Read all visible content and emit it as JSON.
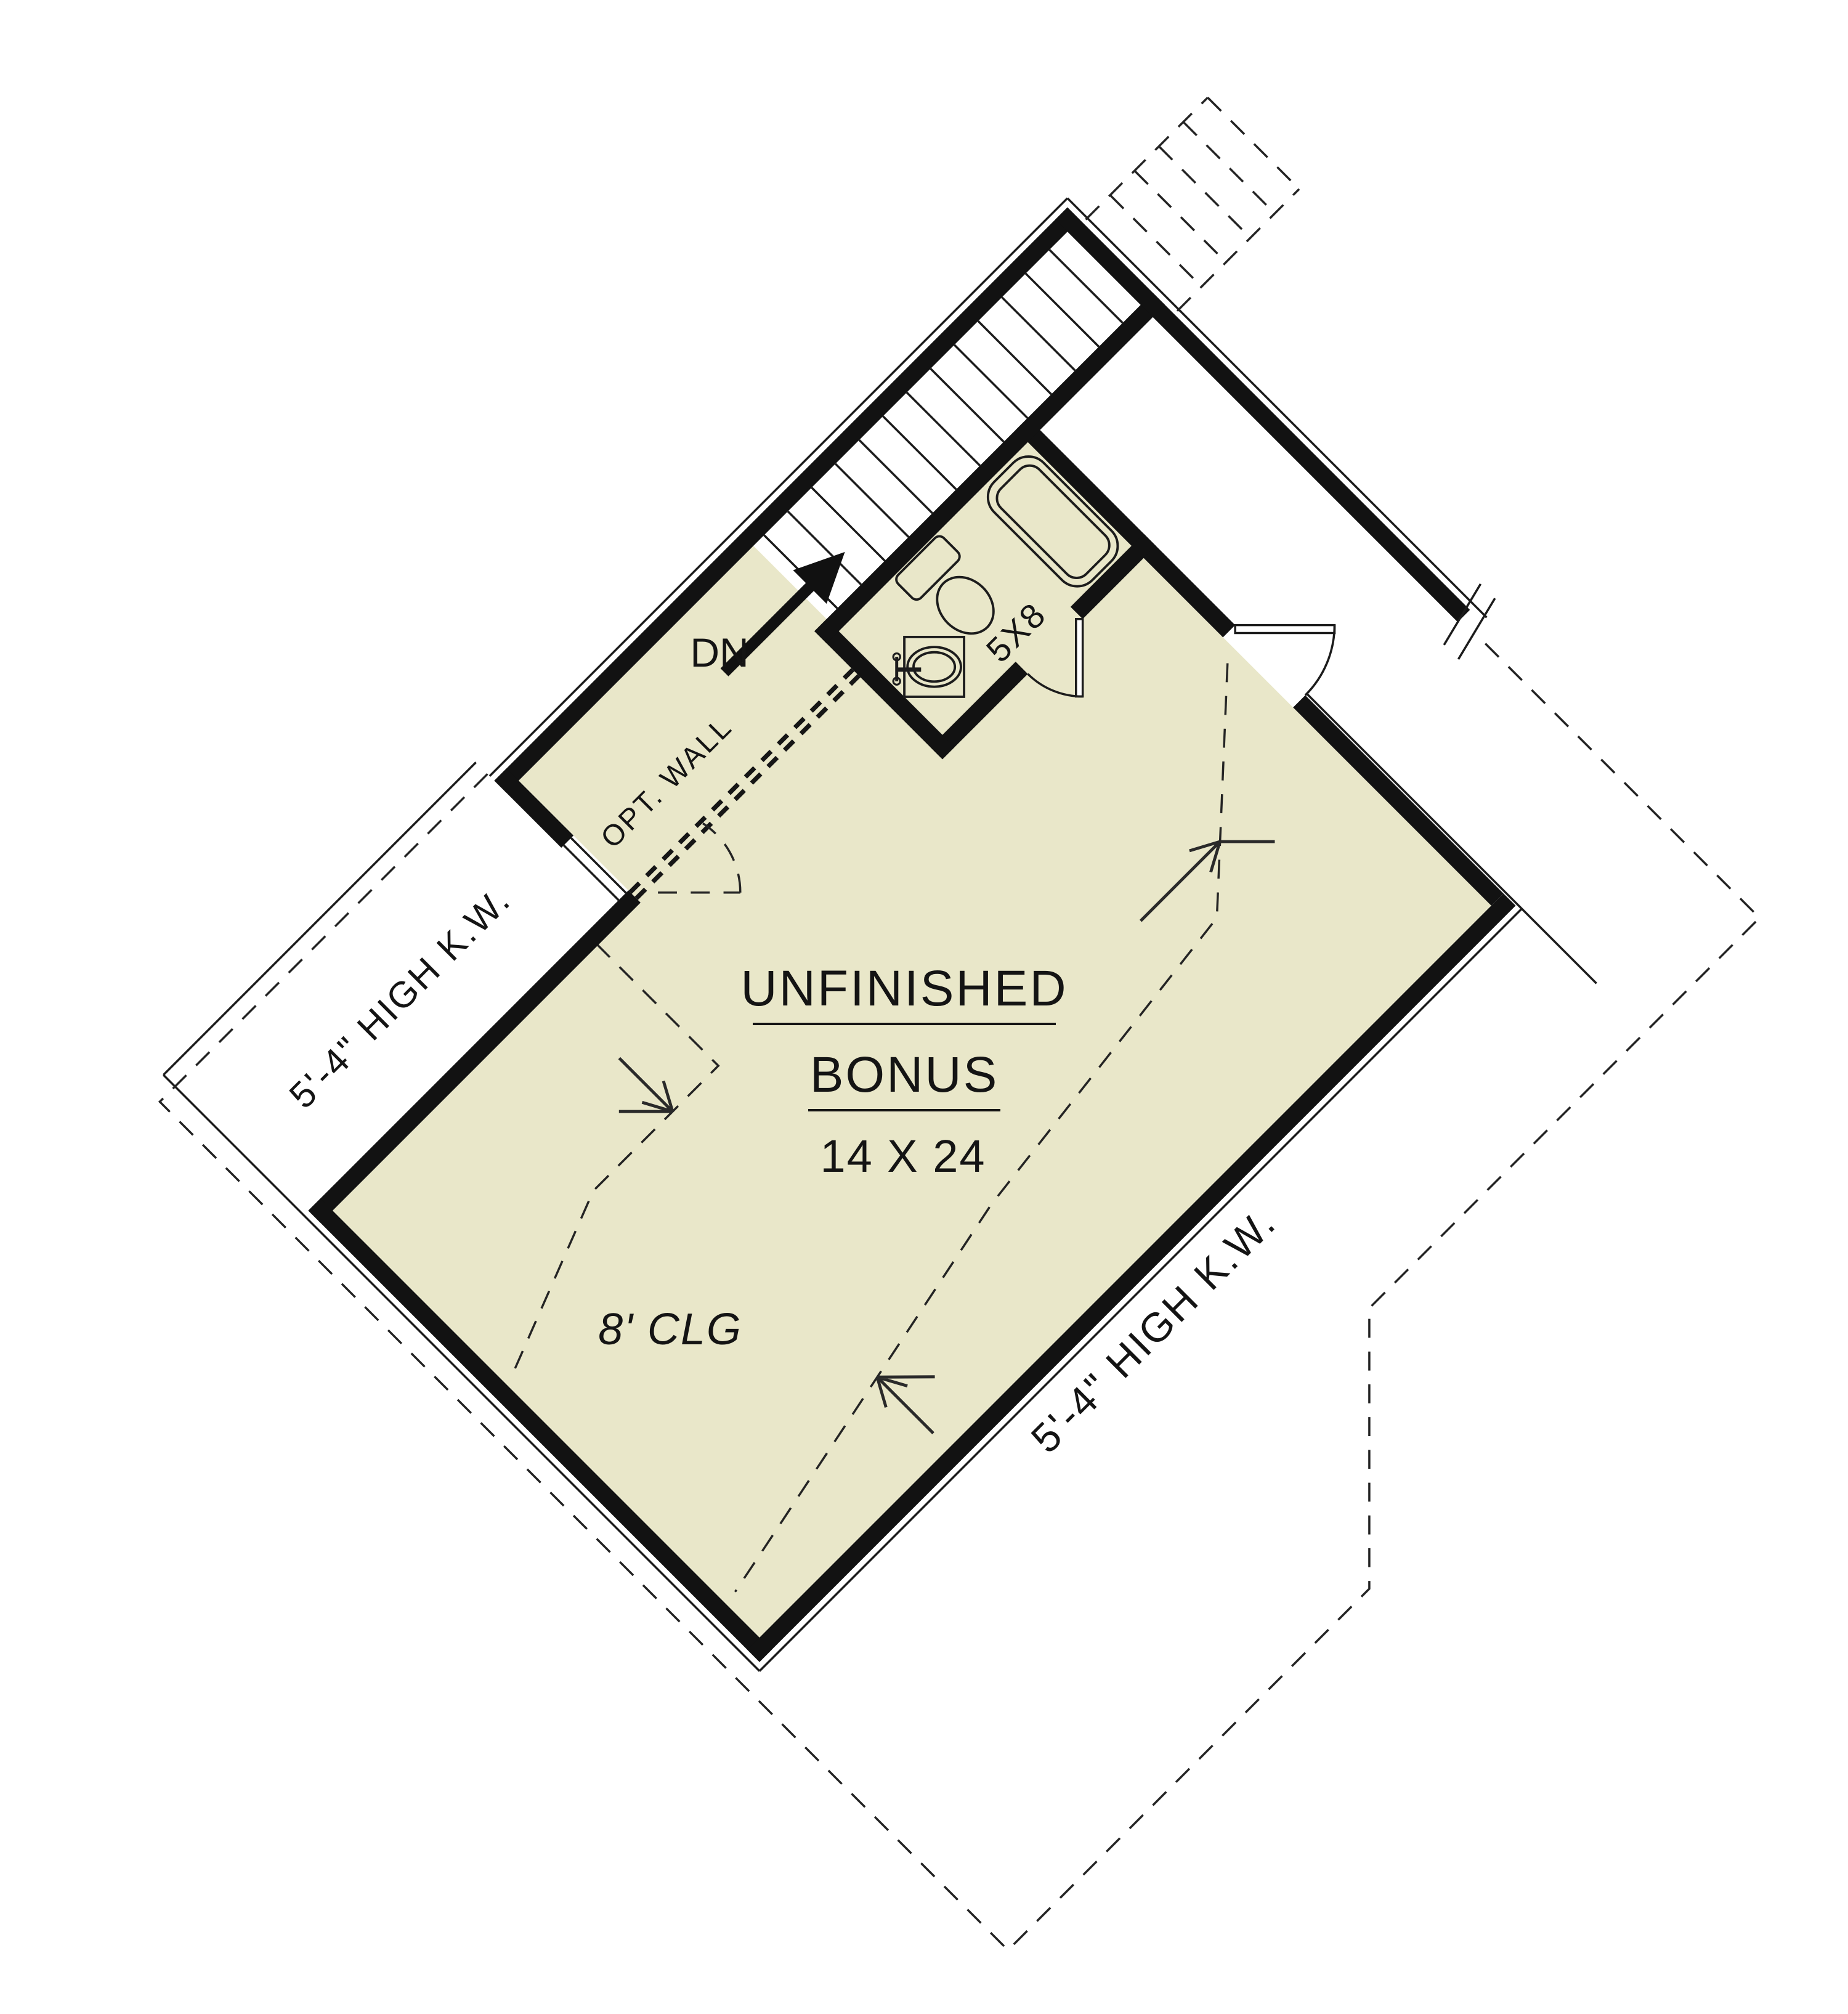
{
  "drawing_type": "second-floor bonus room plan",
  "colors": {
    "floor": "#e9e7c9",
    "wall": "#121212",
    "line": "#1c1c1c",
    "background": "#ffffff"
  },
  "labels": {
    "stair_direction": "DN",
    "optional_wall": "OPT. WALL",
    "bathroom_dimensions": "5X8",
    "room_name_line1": "UNFINISHED",
    "room_name_line2": "BONUS",
    "room_dimensions": "14 X 24",
    "ceiling_height": "8' CLG",
    "knee_wall_left": "5'-4\" HIGH K.W.",
    "knee_wall_right": "5'-4\" HIGH K.W."
  },
  "stairs": {
    "solid_tread_count": 13,
    "dashed_tread_count": 4
  }
}
